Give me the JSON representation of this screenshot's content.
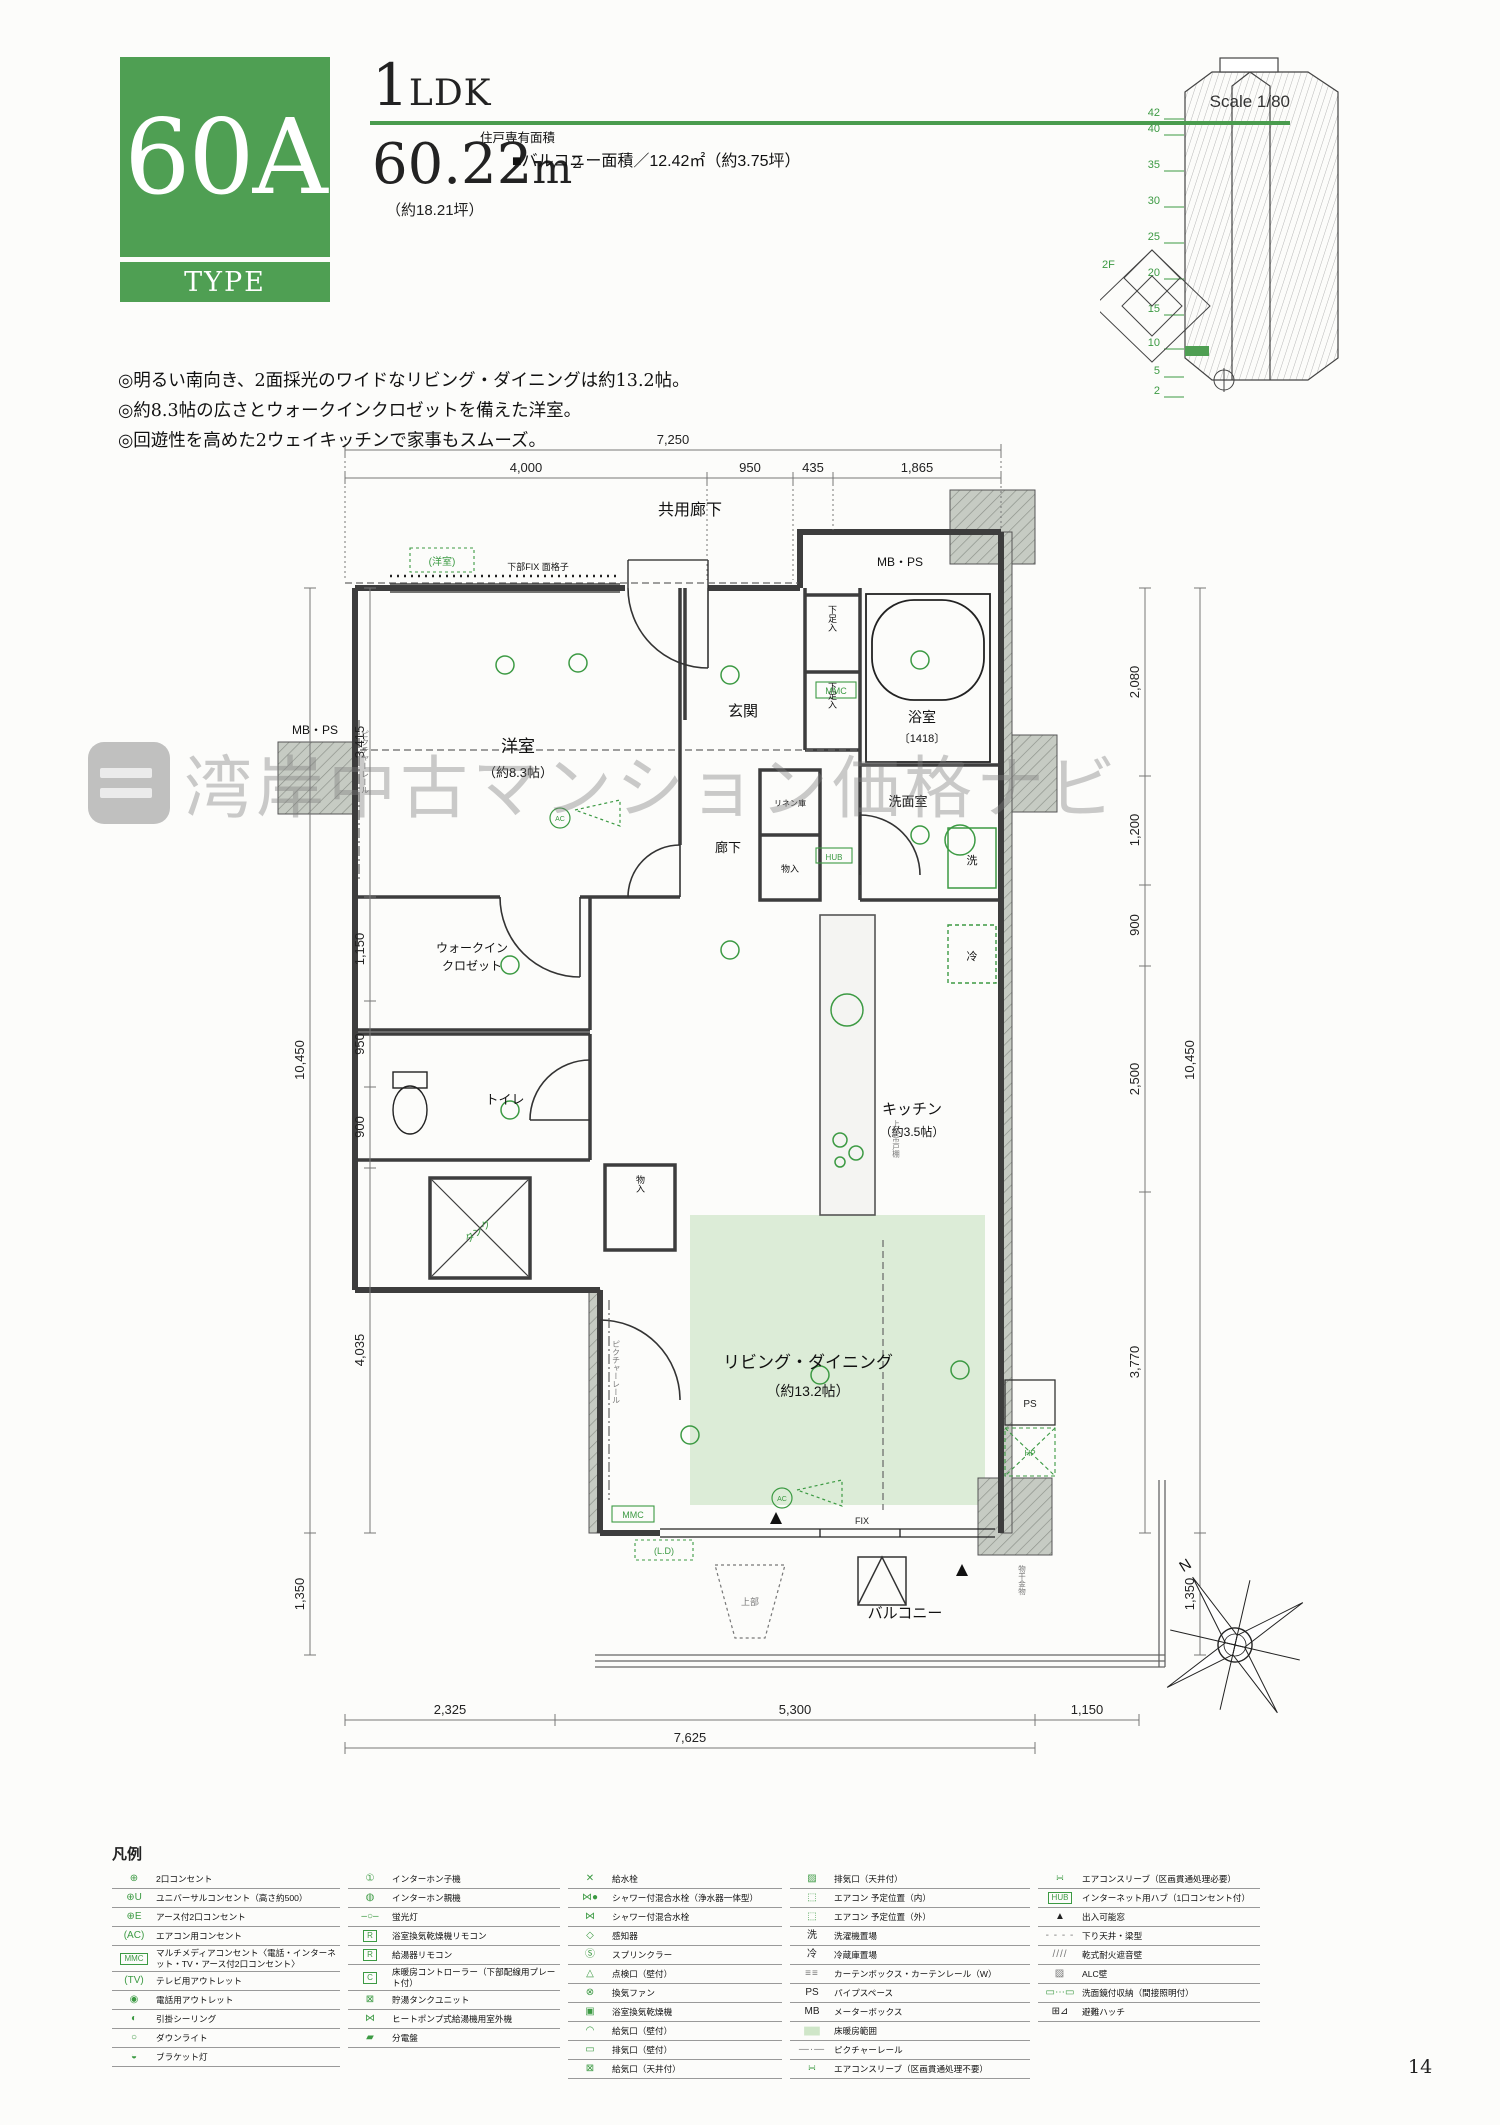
{
  "header": {
    "type_code": "60A",
    "type_label": "TYPE",
    "layout_first": "1",
    "layout_rest": "LDK",
    "scale": "Scale 1/80",
    "area_label": "住戸専有面積",
    "area_value": "60.22",
    "area_unit": "m",
    "area_unit_sup": "2",
    "area_tsubo": "（約18.21坪）",
    "balcony_area": "■バルコニー面積／12.42㎡（約3.75坪）"
  },
  "features": [
    "◎明るい南向き、2面採光のワイドなリビング・ダイニングは約13.2帖。",
    "◎約8.3帖の広さとウォークインクロゼットを備えた洋室。",
    "◎回遊性を高めた2ウェイキッチンで家事もスムーズ。"
  ],
  "tower": {
    "floors": [
      "42",
      "40",
      "35",
      "30",
      "25",
      "20",
      "15",
      "10",
      "5",
      "2"
    ],
    "site_label": "2F"
  },
  "watermark": {
    "text": "湾岸中古マンション価格ナビ"
  },
  "plan": {
    "corridor": "共用廊下",
    "mbps": "MB・PS",
    "western_note": "(洋室)",
    "fix_grille": "下部FIX 面格子",
    "rooms": {
      "western": "洋室",
      "western_size": "（約8.3帖）",
      "entrance": "玄関",
      "shoe": "下足入",
      "linen": "リネン庫",
      "bath": "浴室",
      "bath_size": "〔1418〕",
      "wash": "洗面室",
      "hall": "廊下",
      "storage": "物入",
      "wic1": "ウォークイン",
      "wic2": "クロゼット",
      "toilet": "トイレ",
      "tank": "タンク",
      "kitchen": "キッチン",
      "kitchen_size": "（約3.5帖）",
      "living": "リビング・ダイニング",
      "living_size": "（約13.2帖）",
      "balcony": "バルコニー",
      "washer": "洗",
      "fridge": "冷"
    },
    "marks": {
      "mmc": "MMC",
      "hub": "HUB",
      "ps": "PS",
      "hp": "HP",
      "fix": "FIX",
      "ld": "(L.D)",
      "ac": "AC",
      "upper": "上部",
      "upper_cab": "上部吊戸棚",
      "picture_rail": "ピクチャーレール",
      "laundry": "物干金物",
      "north": "N"
    },
    "dims": {
      "top_total": "7,250",
      "top": [
        "4,000",
        "950",
        "435",
        "1,865"
      ],
      "left_outer": "10,450",
      "left": [
        "3,415",
        "1,150",
        "950",
        "900",
        "4,035"
      ],
      "left_bottom": "1,350",
      "right": [
        "2,080",
        "1,200",
        "900",
        "2,500",
        "3,770"
      ],
      "right_outer": "10,450",
      "right_bottom": "1,350",
      "bottom": [
        "2,325",
        "5,300"
      ],
      "bottom_total": "7,625",
      "bottom_right": "1,150"
    }
  },
  "legend": {
    "title": "凡例",
    "columns": [
      {
        "items": [
          {
            "icon": "⊕",
            "label": "2口コンセント"
          },
          {
            "icon": "⊕U",
            "label": "ユニバーサルコンセント（高さ約500）"
          },
          {
            "icon": "⊕E",
            "label": "アース付2口コンセント"
          },
          {
            "icon": "(AC)",
            "label": "エアコン用コンセント"
          },
          {
            "icon": "MMC",
            "label": "マルチメディアコンセント〈電話・インターネット・TV・アース付2口コンセント〉"
          },
          {
            "icon": "(TV)",
            "label": "テレビ用アウトレット"
          },
          {
            "icon": "◉",
            "label": "電話用アウトレット"
          },
          {
            "icon": "◐",
            "label": "引掛シーリング"
          },
          {
            "icon": "○",
            "label": "ダウンライト"
          },
          {
            "icon": "◒",
            "label": "ブラケット灯"
          }
        ]
      },
      {
        "items": [
          {
            "icon": "①",
            "label": "インターホン子機"
          },
          {
            "icon": "◍",
            "label": "インターホン親機"
          },
          {
            "icon": "–○–",
            "label": "蛍光灯"
          },
          {
            "icon": "R",
            "label": "浴室換気乾燥機リモコン"
          },
          {
            "icon": "R",
            "label": "給湯器リモコン"
          },
          {
            "icon": "C",
            "label": "床暖房コントローラー（下部配線用プレート付）"
          },
          {
            "icon": "⊠",
            "label": "貯湯タンクユニット"
          },
          {
            "icon": "⋈",
            "label": "ヒートポンプ式給湯機用室外機"
          },
          {
            "icon": "▰",
            "label": "分電盤"
          }
        ]
      },
      {
        "items": [
          {
            "icon": "✕",
            "label": "給水栓"
          },
          {
            "icon": "⋈●",
            "label": "シャワー付混合水栓（浄水器一体型）"
          },
          {
            "icon": "⋈",
            "label": "シャワー付混合水栓"
          },
          {
            "icon": "◇",
            "label": "感知器"
          },
          {
            "icon": "Ⓢ",
            "label": "スプリンクラー"
          },
          {
            "icon": "△",
            "label": "点検口（壁付）"
          },
          {
            "icon": "⊗",
            "label": "換気ファン"
          },
          {
            "icon": "▣",
            "label": "浴室換気乾燥機"
          },
          {
            "icon": "◠",
            "label": "給気口（壁付）"
          },
          {
            "icon": "▭",
            "label": "排気口（壁付）"
          },
          {
            "icon": "⊠",
            "label": "給気口（天井付）"
          }
        ]
      },
      {
        "items": [
          {
            "icon": "▨",
            "label": "排気口（天井付）"
          },
          {
            "icon": "⬚",
            "label": "エアコン 予定位置（内）"
          },
          {
            "icon": "⬚",
            "label": "エアコン 予定位置（外）"
          },
          {
            "icon": "洗",
            "label": "洗濯機置場"
          },
          {
            "icon": "冷",
            "label": "冷蔵庫置場"
          },
          {
            "icon": "≡≡",
            "label": "カーテンボックス・カーテンレール（W）"
          },
          {
            "icon": "PS",
            "label": "パイプスペース"
          },
          {
            "icon": "MB",
            "label": "メーターボックス"
          },
          {
            "icon": "▆▆",
            "label": "床暖房範囲"
          },
          {
            "icon": "—·—",
            "label": "ピクチャーレール"
          },
          {
            "icon": "∺",
            "label": "エアコンスリーブ（区画貫通処理不要）"
          }
        ]
      },
      {
        "items": [
          {
            "icon": "∺",
            "label": "エアコンスリーブ（区画貫通処理必要）"
          },
          {
            "icon": "HUB",
            "label": "インターネット用ハブ（1口コンセント付）"
          },
          {
            "icon": "▲",
            "label": "出入可能窓"
          },
          {
            "icon": "- - - -",
            "label": "下り天井・梁型"
          },
          {
            "icon": "////",
            "label": "乾式耐火遮音壁"
          },
          {
            "icon": "▨",
            "label": "ALC壁"
          },
          {
            "icon": "▭⋯▭",
            "label": "洗面鏡付収納（間接照明付）"
          },
          {
            "icon": "⊞⊿",
            "label": "避難ハッチ"
          }
        ]
      }
    ]
  },
  "page": {
    "number": "14"
  }
}
